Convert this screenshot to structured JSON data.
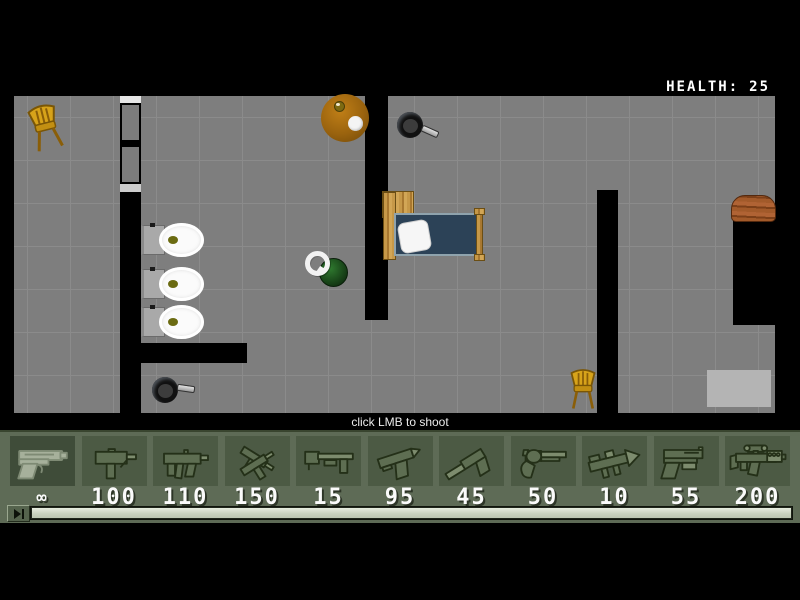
{
  "hud": {
    "health_label": "HEALTH:",
    "health_value": "25",
    "hint": "click LMB to shoot"
  },
  "weapons": [
    {
      "name": "desert-eagle-pistol",
      "ammo": "∞",
      "selected": true
    },
    {
      "name": "mac10-smg",
      "ammo": "100",
      "selected": false
    },
    {
      "name": "mp5k-smg",
      "ammo": "110",
      "selected": false
    },
    {
      "name": "dual-uzis",
      "ammo": "150",
      "selected": false
    },
    {
      "name": "pump-shotgun",
      "ammo": "15",
      "selected": false
    },
    {
      "name": "tmp-machine-pistol",
      "ammo": "95",
      "selected": false
    },
    {
      "name": "silenced-pistol",
      "ammo": "45",
      "selected": false
    },
    {
      "name": "revolver",
      "ammo": "50",
      "selected": false
    },
    {
      "name": "rocket-launcher",
      "ammo": "10",
      "selected": false
    },
    {
      "name": "tactical-pistol",
      "ammo": "55",
      "selected": false
    },
    {
      "name": "scoped-rifle",
      "ammo": "200",
      "selected": false
    }
  ],
  "playback": {
    "play_icon": "play-next-icon",
    "progress_percent": 100
  },
  "map": {
    "objects": [
      "wooden-chair",
      "round-table",
      "frying-pan",
      "bed",
      "toilet",
      "toilet",
      "toilet",
      "player-character",
      "frying-pan",
      "wooden-chair",
      "wood-log",
      "exit-pad",
      "sliding-door"
    ]
  },
  "colors": {
    "background": "#000000",
    "floor": "#7e7e7e",
    "grid_line": "#8b8b8b",
    "weapon_bar": "#5e6b56",
    "slot": "#4c5a44",
    "ammo_text": "#fafafa",
    "health_text": "#ffffff",
    "mattress": "#2c4257",
    "wood": "#c69848",
    "chair_gold": "#d7a31a",
    "progress_fill": "#c8d1bd"
  }
}
